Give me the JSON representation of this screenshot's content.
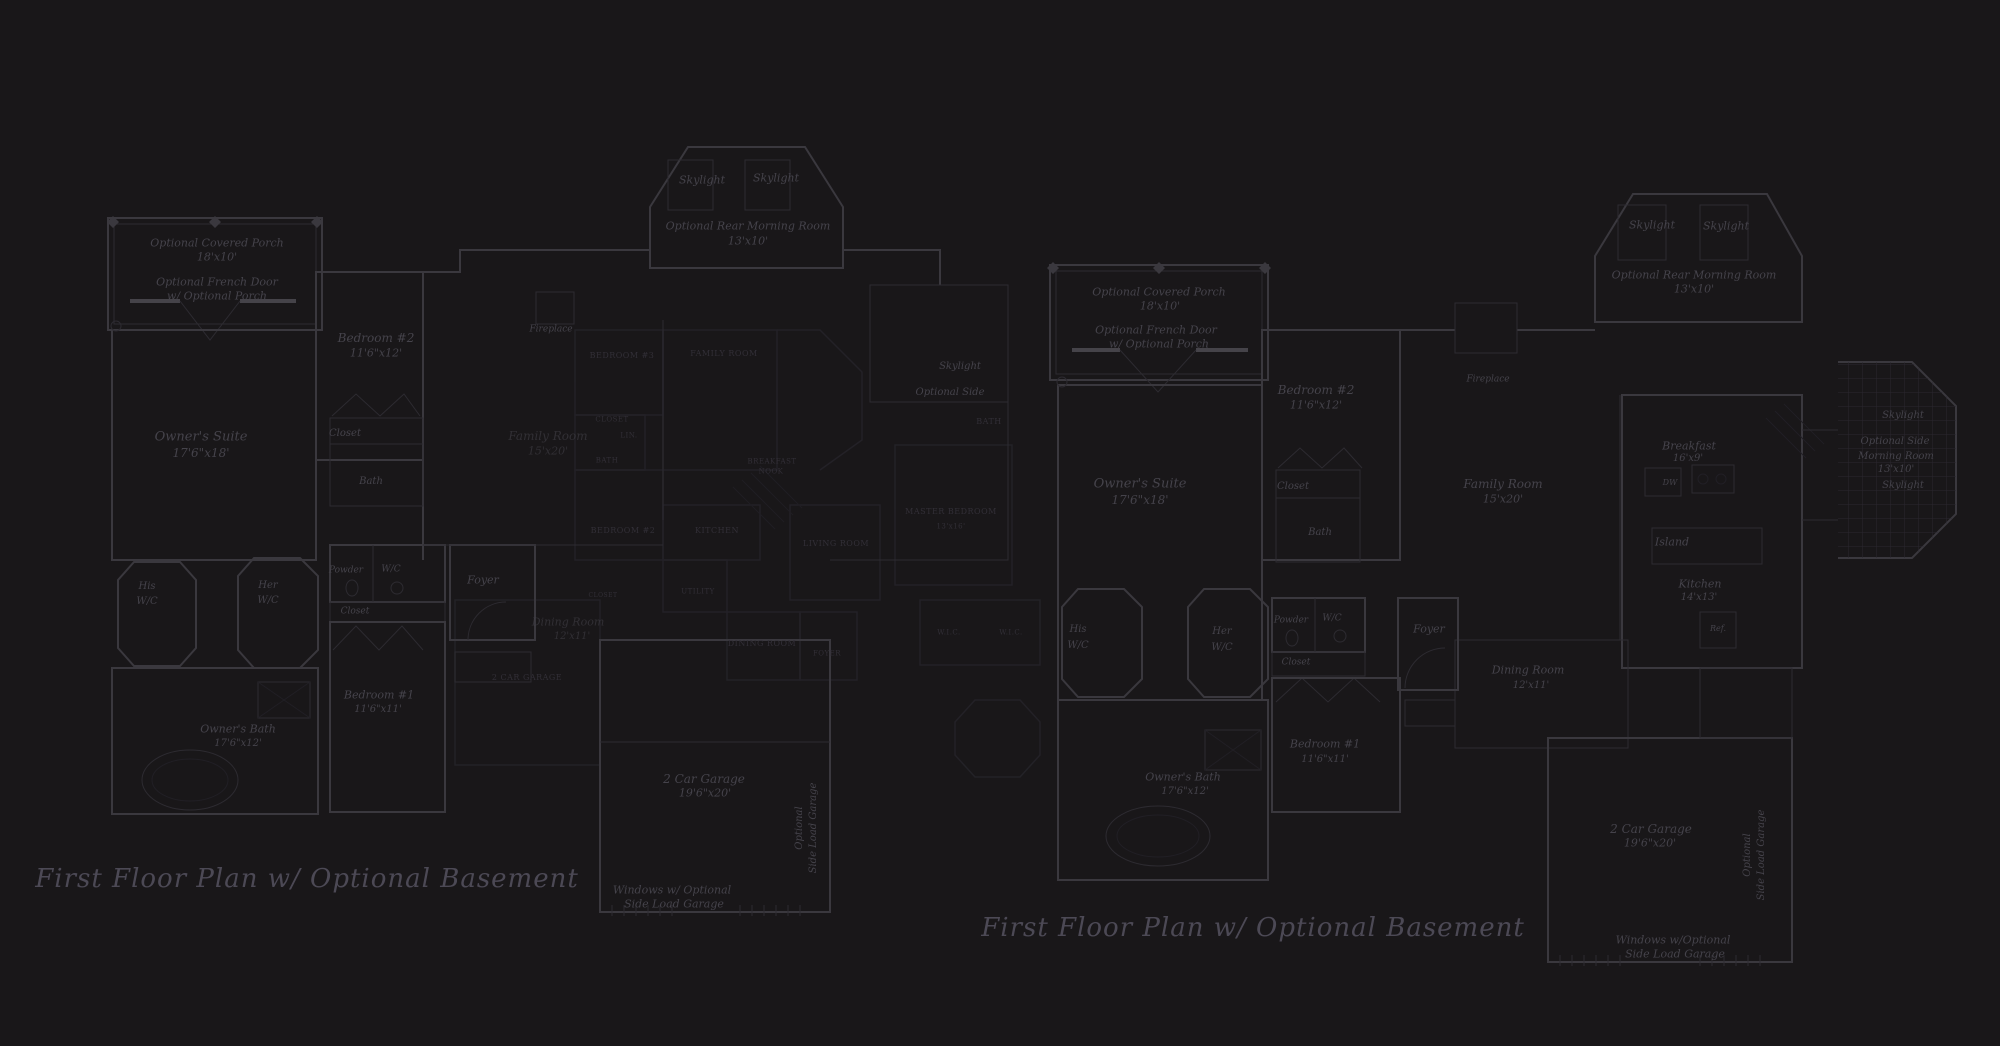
{
  "colors": {
    "background": "#191719",
    "wall": "#3a383e",
    "wall_bold": "#454349",
    "wall_faint": "#2d2b31",
    "overlap_plan": "#252329",
    "label_text": "#45434b",
    "caps_text": "#322f37",
    "title_text": "#4c4955"
  },
  "titles": {
    "left": {
      "text": "First Floor Plan  w/ Optional Basement"
    },
    "right": {
      "text": "First Floor Plan  w/ Optional Basement"
    }
  },
  "labels": [
    {
      "id": "left-porch-name",
      "t": "Optional Covered Porch",
      "x": 217,
      "y": 243,
      "s": 11
    },
    {
      "id": "left-porch-dims",
      "t": "18'x10'",
      "x": 217,
      "y": 257,
      "s": 11
    },
    {
      "id": "left-french-door-1",
      "t": "Optional French Door",
      "x": 217,
      "y": 282,
      "s": 11
    },
    {
      "id": "left-french-door-2",
      "t": "w/ Optional Porch",
      "x": 217,
      "y": 296,
      "s": 11
    },
    {
      "id": "left-bedroom2-name",
      "t": "Bedroom #2",
      "x": 376,
      "y": 338,
      "s": 12
    },
    {
      "id": "left-bedroom2-dims",
      "t": "11'6\"x12'",
      "x": 376,
      "y": 353,
      "s": 11
    },
    {
      "id": "left-owners-suite-name",
      "t": "Owner's Suite",
      "x": 201,
      "y": 437,
      "s": 13
    },
    {
      "id": "left-owners-suite-dims",
      "t": "17'6\"x18'",
      "x": 201,
      "y": 453,
      "s": 12
    },
    {
      "id": "left-closet-upper",
      "t": "Closet",
      "x": 345,
      "y": 434,
      "s": 10
    },
    {
      "id": "left-bath-upper",
      "t": "Bath",
      "x": 371,
      "y": 482,
      "s": 10
    },
    {
      "id": "left-skylight-1",
      "t": "Skylight",
      "x": 702,
      "y": 180,
      "s": 11
    },
    {
      "id": "left-skylight-2",
      "t": "Skylight",
      "x": 776,
      "y": 178,
      "s": 11
    },
    {
      "id": "left-morning-room-name",
      "t": "Optional Rear Morning Room",
      "x": 748,
      "y": 226,
      "s": 11
    },
    {
      "id": "left-morning-room-dims",
      "t": "13'x10'",
      "x": 748,
      "y": 241,
      "s": 11
    },
    {
      "id": "left-fireplace",
      "t": "Fireplace",
      "x": 551,
      "y": 330,
      "s": 9
    },
    {
      "id": "left-family-room-name",
      "t": "Family Room",
      "x": 548,
      "y": 436,
      "s": 12,
      "c": "it dim"
    },
    {
      "id": "left-family-room-dims",
      "t": "15'x20'",
      "x": 548,
      "y": 451,
      "s": 11,
      "c": "it dim"
    },
    {
      "id": "left-his-1",
      "t": "His",
      "x": 147,
      "y": 587,
      "s": 10
    },
    {
      "id": "left-his-2",
      "t": "W/C",
      "x": 147,
      "y": 602,
      "s": 10
    },
    {
      "id": "left-her-1",
      "t": "Her",
      "x": 268,
      "y": 586,
      "s": 10
    },
    {
      "id": "left-her-2",
      "t": "W/C",
      "x": 268,
      "y": 601,
      "s": 10
    },
    {
      "id": "left-powder",
      "t": "Powder",
      "x": 346,
      "y": 571,
      "s": 9
    },
    {
      "id": "left-wc",
      "t": "W/C",
      "x": 391,
      "y": 570,
      "s": 9
    },
    {
      "id": "left-closet-lower",
      "t": "Closet",
      "x": 355,
      "y": 612,
      "s": 9
    },
    {
      "id": "left-foyer",
      "t": "Foyer",
      "x": 483,
      "y": 580,
      "s": 11
    },
    {
      "id": "left-bedroom1-name",
      "t": "Bedroom #1",
      "x": 379,
      "y": 695,
      "s": 11
    },
    {
      "id": "left-bedroom1-dims",
      "t": "11'6\"x11'",
      "x": 378,
      "y": 710,
      "s": 10
    },
    {
      "id": "left-owners-bath-name",
      "t": "Owner's Bath",
      "x": 238,
      "y": 729,
      "s": 11
    },
    {
      "id": "left-owners-bath-dims",
      "t": "17'6\"x12'",
      "x": 238,
      "y": 744,
      "s": 10
    },
    {
      "id": "left-dining-name",
      "t": "Dining Room",
      "x": 568,
      "y": 622,
      "s": 11,
      "c": "it dim"
    },
    {
      "id": "left-dining-dims",
      "t": "12'x11'",
      "x": 572,
      "y": 637,
      "s": 10,
      "c": "it dim"
    },
    {
      "id": "left-garage-name",
      "t": "2 Car Garage",
      "x": 704,
      "y": 779,
      "s": 12
    },
    {
      "id": "left-garage-dims",
      "t": "19'6\"x20'",
      "x": 705,
      "y": 793,
      "s": 11
    },
    {
      "id": "left-garage-opt-1",
      "t": "Optional",
      "x": 800,
      "y": 828,
      "s": 10,
      "r": -90
    },
    {
      "id": "left-garage-opt-2",
      "t": "Side Load Garage",
      "x": 814,
      "y": 828,
      "s": 10,
      "r": -90
    },
    {
      "id": "left-garage-windows-1",
      "t": "Windows w/ Optional",
      "x": 672,
      "y": 890,
      "s": 11
    },
    {
      "id": "left-garage-windows-2",
      "t": "Side Load Garage",
      "x": 674,
      "y": 904,
      "s": 11
    },
    {
      "id": "left-side-skylight",
      "t": "Skylight",
      "x": 960,
      "y": 367,
      "s": 10
    },
    {
      "id": "left-side-optional",
      "t": "Optional Side",
      "x": 950,
      "y": 393,
      "s": 10
    },
    {
      "id": "mid-bedroom3",
      "t": "BEDROOM #3",
      "x": 622,
      "y": 356,
      "s": 8,
      "c": "cap"
    },
    {
      "id": "mid-family-room",
      "t": "FAMILY ROOM",
      "x": 724,
      "y": 354,
      "s": 8,
      "c": "cap"
    },
    {
      "id": "mid-closet-1",
      "t": "CLOSET",
      "x": 612,
      "y": 420,
      "s": 7,
      "c": "cap"
    },
    {
      "id": "mid-lin",
      "t": "LIN.",
      "x": 629,
      "y": 436,
      "s": 7,
      "c": "cap"
    },
    {
      "id": "mid-bath-1",
      "t": "BATH",
      "x": 607,
      "y": 461,
      "s": 7,
      "c": "cap"
    },
    {
      "id": "mid-breakfast",
      "t": "BREAKFAST",
      "x": 772,
      "y": 462,
      "s": 7,
      "c": "cap"
    },
    {
      "id": "mid-nook",
      "t": "NOOK",
      "x": 771,
      "y": 472,
      "s": 7,
      "c": "cap"
    },
    {
      "id": "mid-bedroom2",
      "t": "BEDROOM #2",
      "x": 623,
      "y": 531,
      "s": 8,
      "c": "cap"
    },
    {
      "id": "mid-kitchen",
      "t": "KITCHEN",
      "x": 717,
      "y": 531,
      "s": 8,
      "c": "cap"
    },
    {
      "id": "mid-living-room",
      "t": "LIVING ROOM",
      "x": 836,
      "y": 544,
      "s": 8,
      "c": "cap"
    },
    {
      "id": "mid-utility",
      "t": "UTILITY",
      "x": 698,
      "y": 592,
      "s": 7,
      "c": "cap"
    },
    {
      "id": "mid-closet-2",
      "t": "CLOSET",
      "x": 603,
      "y": 596,
      "s": 6,
      "c": "cap"
    },
    {
      "id": "mid-dining-room",
      "t": "DINING ROOM",
      "x": 762,
      "y": 644,
      "s": 8,
      "c": "cap"
    },
    {
      "id": "mid-foyer",
      "t": "FOYER",
      "x": 827,
      "y": 654,
      "s": 7,
      "c": "cap"
    },
    {
      "id": "mid-bath-2",
      "t": "BATH",
      "x": 989,
      "y": 422,
      "s": 8,
      "c": "cap"
    },
    {
      "id": "mid-master-bedroom",
      "t": "MASTER BEDROOM",
      "x": 951,
      "y": 512,
      "s": 8,
      "c": "cap"
    },
    {
      "id": "mid-master-dims",
      "t": "13'x16'",
      "x": 951,
      "y": 527,
      "s": 7,
      "c": "cap"
    },
    {
      "id": "mid-wic-1",
      "t": "W.I.C.",
      "x": 949,
      "y": 633,
      "s": 7,
      "c": "cap"
    },
    {
      "id": "mid-wic-2",
      "t": "W.I.C.",
      "x": 1011,
      "y": 633,
      "s": 7,
      "c": "cap"
    },
    {
      "id": "mid-garage",
      "t": "2 CAR GARAGE",
      "x": 527,
      "y": 678,
      "s": 8,
      "c": "cap"
    },
    {
      "id": "right-porch-name",
      "t": "Optional Covered Porch",
      "x": 1159,
      "y": 292,
      "s": 11
    },
    {
      "id": "right-porch-dims",
      "t": "18'x10'",
      "x": 1160,
      "y": 306,
      "s": 11
    },
    {
      "id": "right-french-door-1",
      "t": "Optional French Door",
      "x": 1156,
      "y": 330,
      "s": 11
    },
    {
      "id": "right-french-door-2",
      "t": "w/ Optional Porch",
      "x": 1159,
      "y": 344,
      "s": 11
    },
    {
      "id": "right-bedroom2-name",
      "t": "Bedroom #2",
      "x": 1316,
      "y": 390,
      "s": 12
    },
    {
      "id": "right-bedroom2-dims",
      "t": "11'6\"x12'",
      "x": 1316,
      "y": 405,
      "s": 11
    },
    {
      "id": "right-owners-suite-name",
      "t": "Owner's Suite",
      "x": 1140,
      "y": 484,
      "s": 13
    },
    {
      "id": "right-owners-suite-dims",
      "t": "17'6\"x18'",
      "x": 1140,
      "y": 500,
      "s": 12
    },
    {
      "id": "right-closet-upper",
      "t": "Closet",
      "x": 1293,
      "y": 487,
      "s": 10
    },
    {
      "id": "right-bath-upper",
      "t": "Bath",
      "x": 1320,
      "y": 533,
      "s": 10
    },
    {
      "id": "right-fireplace",
      "t": "Fireplace",
      "x": 1488,
      "y": 380,
      "s": 9
    },
    {
      "id": "right-family-room-name",
      "t": "Family Room",
      "x": 1503,
      "y": 484,
      "s": 12
    },
    {
      "id": "right-family-room-dims",
      "t": "15'x20'",
      "x": 1503,
      "y": 499,
      "s": 11
    },
    {
      "id": "right-skylight-1",
      "t": "Skylight",
      "x": 1652,
      "y": 225,
      "s": 11
    },
    {
      "id": "right-skylight-2",
      "t": "Skylight",
      "x": 1726,
      "y": 226,
      "s": 11
    },
    {
      "id": "right-morning-room-name",
      "t": "Optional Rear Morning Room",
      "x": 1694,
      "y": 275,
      "s": 11
    },
    {
      "id": "right-morning-room-dims",
      "t": "13'x10'",
      "x": 1694,
      "y": 289,
      "s": 11
    },
    {
      "id": "right-breakfast-name",
      "t": "Breakfast",
      "x": 1689,
      "y": 446,
      "s": 11
    },
    {
      "id": "right-breakfast-dims",
      "t": "16'x9'",
      "x": 1688,
      "y": 459,
      "s": 10
    },
    {
      "id": "right-dw",
      "t": "DW",
      "x": 1670,
      "y": 483,
      "s": 8
    },
    {
      "id": "right-island",
      "t": "Island",
      "x": 1672,
      "y": 542,
      "s": 11
    },
    {
      "id": "right-kitchen-name",
      "t": "Kitchen",
      "x": 1700,
      "y": 584,
      "s": 11
    },
    {
      "id": "right-kitchen-dims",
      "t": "14'x13'",
      "x": 1699,
      "y": 598,
      "s": 10
    },
    {
      "id": "right-ref",
      "t": "Ref.",
      "x": 1718,
      "y": 629,
      "s": 8
    },
    {
      "id": "right-side-skylight-1",
      "t": "Skylight",
      "x": 1903,
      "y": 416,
      "s": 10
    },
    {
      "id": "right-side-morning-1",
      "t": "Optional Side",
      "x": 1895,
      "y": 442,
      "s": 10
    },
    {
      "id": "right-side-morning-2",
      "t": "Morning Room",
      "x": 1896,
      "y": 457,
      "s": 10
    },
    {
      "id": "right-side-morning-dims",
      "t": "13'x10'",
      "x": 1896,
      "y": 470,
      "s": 10
    },
    {
      "id": "right-side-skylight-2",
      "t": "Skylight",
      "x": 1903,
      "y": 486,
      "s": 10
    },
    {
      "id": "right-foyer",
      "t": "Foyer",
      "x": 1429,
      "y": 629,
      "s": 11
    },
    {
      "id": "right-dining-name",
      "t": "Dining Room",
      "x": 1528,
      "y": 670,
      "s": 11
    },
    {
      "id": "right-dining-dims",
      "t": "12'x11'",
      "x": 1531,
      "y": 686,
      "s": 10
    },
    {
      "id": "right-his-1",
      "t": "His",
      "x": 1078,
      "y": 630,
      "s": 10
    },
    {
      "id": "right-his-2",
      "t": "W/C",
      "x": 1078,
      "y": 646,
      "s": 10
    },
    {
      "id": "right-her-1",
      "t": "Her",
      "x": 1222,
      "y": 632,
      "s": 10
    },
    {
      "id": "right-her-2",
      "t": "W/C",
      "x": 1222,
      "y": 648,
      "s": 10
    },
    {
      "id": "right-powder",
      "t": "Powder",
      "x": 1291,
      "y": 621,
      "s": 9
    },
    {
      "id": "right-wc",
      "t": "W/C",
      "x": 1332,
      "y": 619,
      "s": 9
    },
    {
      "id": "right-closet-lower",
      "t": "Closet",
      "x": 1296,
      "y": 663,
      "s": 9
    },
    {
      "id": "right-bedroom1-name",
      "t": "Bedroom #1",
      "x": 1325,
      "y": 744,
      "s": 11
    },
    {
      "id": "right-bedroom1-dims",
      "t": "11'6\"x11'",
      "x": 1325,
      "y": 760,
      "s": 10
    },
    {
      "id": "right-owners-bath-name",
      "t": "Owner's Bath",
      "x": 1183,
      "y": 777,
      "s": 11
    },
    {
      "id": "right-owners-bath-dims",
      "t": "17'6\"x12'",
      "x": 1185,
      "y": 792,
      "s": 10
    },
    {
      "id": "right-garage-name",
      "t": "2 Car Garage",
      "x": 1651,
      "y": 829,
      "s": 12
    },
    {
      "id": "right-garage-dims",
      "t": "19'6\"x20'",
      "x": 1650,
      "y": 843,
      "s": 11
    },
    {
      "id": "right-garage-opt-1",
      "t": "Optional",
      "x": 1748,
      "y": 855,
      "s": 10,
      "r": -90
    },
    {
      "id": "right-garage-opt-2",
      "t": "Side Load Garage",
      "x": 1762,
      "y": 855,
      "s": 10,
      "r": -90
    },
    {
      "id": "right-garage-windows-1",
      "t": "Windows w/Optional",
      "x": 1673,
      "y": 940,
      "s": 11
    },
    {
      "id": "right-garage-windows-2",
      "t": "Side Load Garage",
      "x": 1675,
      "y": 954,
      "s": 11
    }
  ]
}
